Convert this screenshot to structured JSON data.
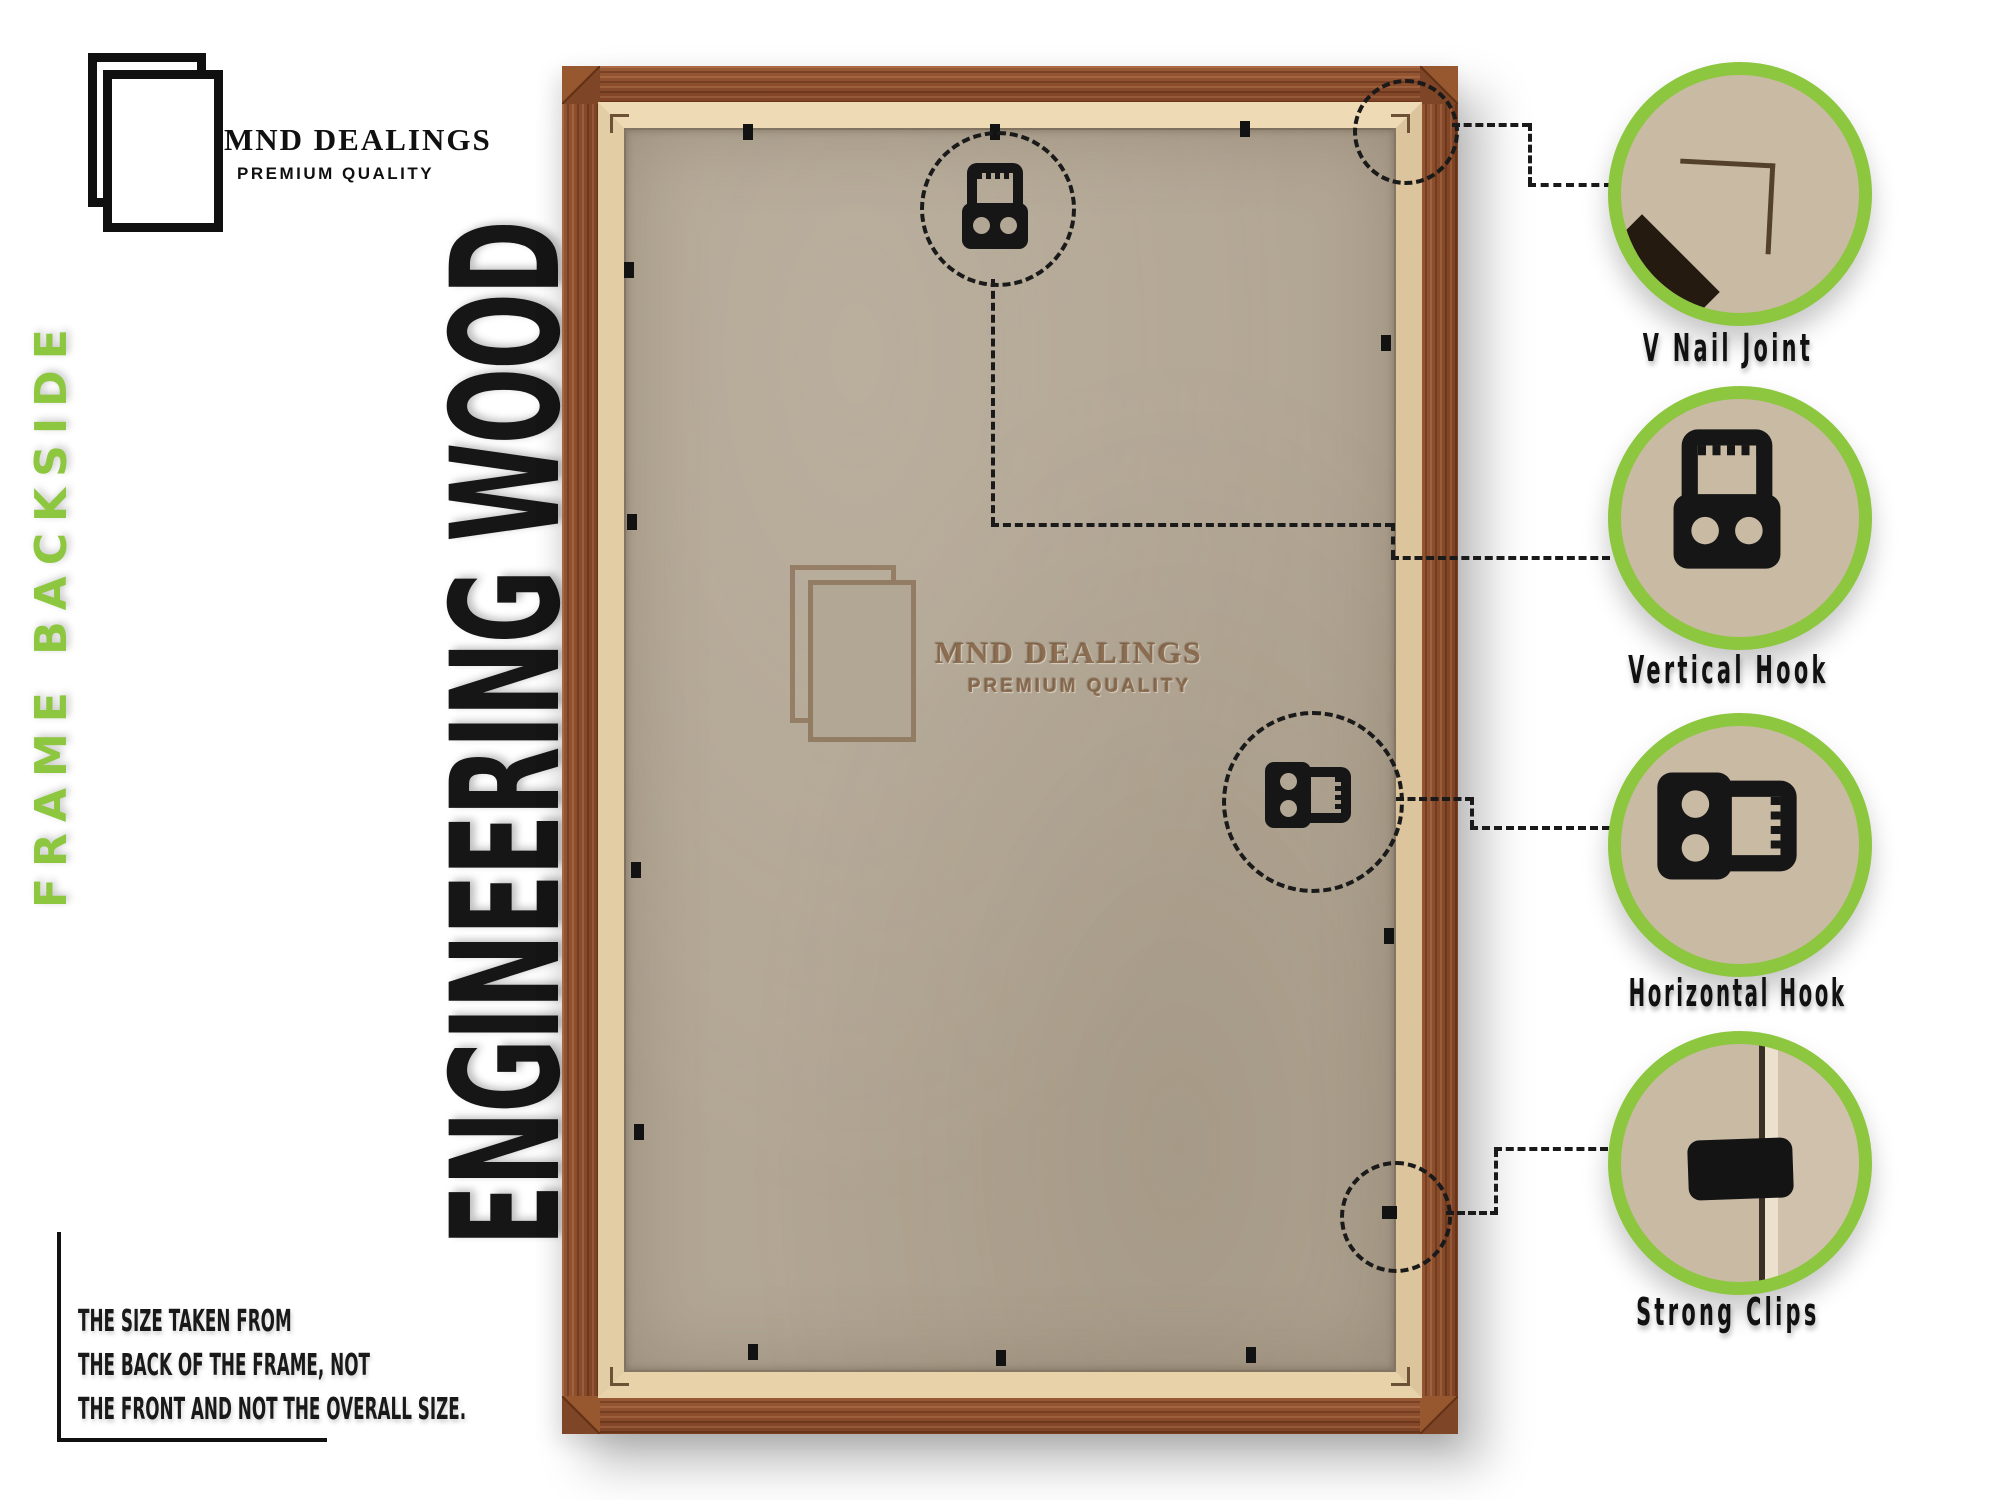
{
  "brand": {
    "name": "MND DEALINGS",
    "tagline": "PREMIUM QUALITY"
  },
  "side_labels": {
    "frame_backside": "FRAME BACKSIDE",
    "engineering_wood": "ENGINEERING WOOD"
  },
  "size_note": {
    "line1": "THE SIZE TAKEN FROM",
    "line2": "THE BACK OF THE FRAME, NOT",
    "line3": "THE FRONT AND NOT THE OVERALL SIZE."
  },
  "watermark": {
    "name": "MND DEALINGS",
    "tagline": "PREMIUM QUALITY"
  },
  "callouts": [
    {
      "id": "v-nail-joint",
      "label": "V Nail Joint"
    },
    {
      "id": "vertical-hook",
      "label": "Vertical Hook"
    },
    {
      "id": "horizontal-hook",
      "label": "Horizontal Hook"
    },
    {
      "id": "strong-clips",
      "label": "Strong Clips"
    }
  ],
  "colors": {
    "accent_green": "#8dc63f",
    "wood_brown": "#8a4c2b",
    "liner_tan": "#e6d0a8",
    "board_tan": "#b2a694",
    "hardware_black": "#161616",
    "text_black": "#141414"
  }
}
